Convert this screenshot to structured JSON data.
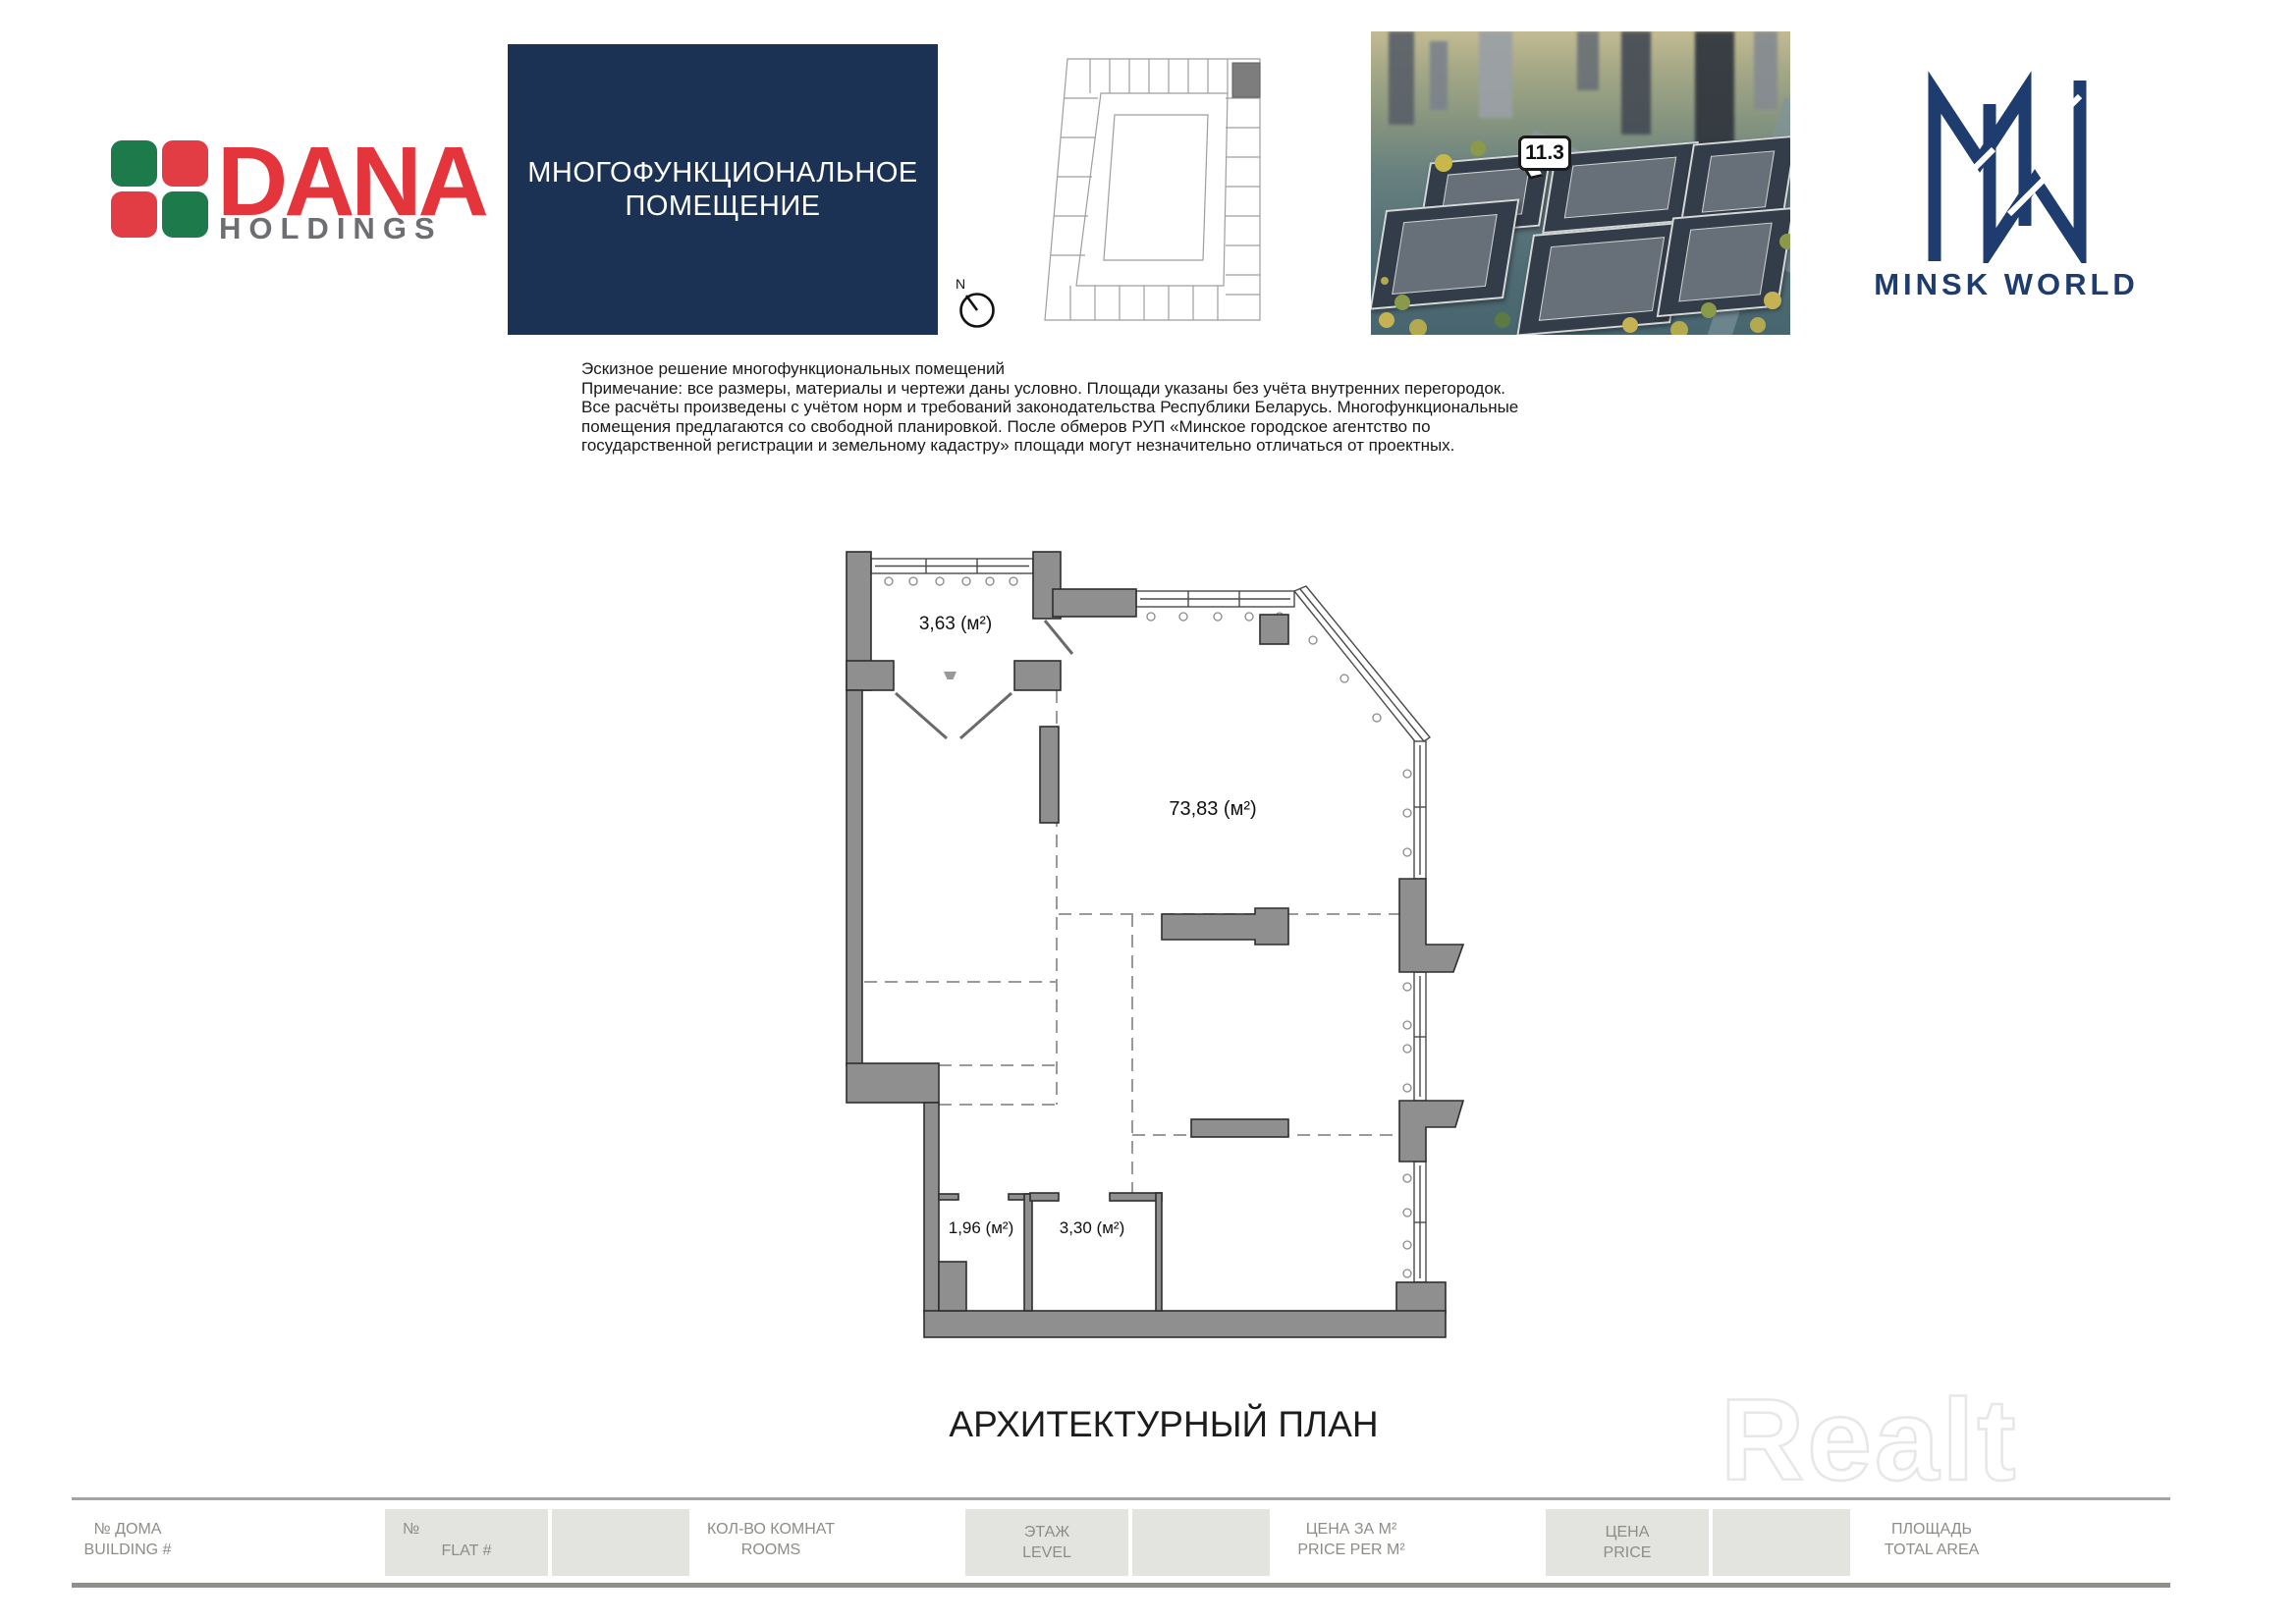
{
  "brand": {
    "dana": {
      "name": "DANA",
      "subtitle": "HOLDINGS"
    },
    "minsk_world": {
      "name": "MINSK WORLD"
    }
  },
  "title_box": {
    "line1": "МНОГОФУНКЦИОНАЛЬНОЕ",
    "line2": "ПОМЕЩЕНИЕ"
  },
  "site": {
    "compass": "N",
    "building_callout": "11.3"
  },
  "notes": {
    "line1": "Эскизное решение многофункциональных помещений",
    "line2": "Примечание: все размеры, материалы и чертежи даны условно. Площади указаны без учёта внутренних перегородок.",
    "line3": "Все расчёты произведены с учётом норм и требований законодательства Республики Беларусь. Многофункциональные",
    "line4": "помещения предлагаются со свободной планировкой. После обмеров РУП «Минское городское агентство по",
    "line5": "государственной регистрации и земельному кадастру» площади могут незначительно отличаться от проектных."
  },
  "plan": {
    "title": "АРХИТЕКТУРНЫЙ ПЛАН",
    "areas": {
      "balcony": "3,63 (м²)",
      "main": "73,83 (м²)",
      "small1": "1,96 (м²)",
      "small2": "3,30 (м²)"
    }
  },
  "watermark": "Realt",
  "footer": {
    "building": {
      "ru": "№ ДОМА",
      "en": "BUILDING #"
    },
    "flat": {
      "corner": "№",
      "en": "FLAT #"
    },
    "rooms": {
      "ru": "КОЛ-ВО КОМНАТ",
      "en": "ROOMS"
    },
    "level": {
      "ru": "ЭТАЖ",
      "en": "LEVEL"
    },
    "price_per_m": {
      "ru": "ЦЕНА ЗА М²",
      "en": "PRICE PER M²"
    },
    "price": {
      "ru": "ЦЕНА",
      "en": "PRICE"
    },
    "area": {
      "ru": "ПЛОЩАДЬ",
      "en": "TOTAL AREA"
    }
  },
  "colors": {
    "navy": "#1b3255",
    "logo_navy": "#1e3c6e",
    "dana_red": "#e5353c",
    "dana_green": "#1d7a4a",
    "wall_gray": "#8f8f8f",
    "footer_gray": "#e3e3e0",
    "footer_text": "#8d8d88"
  }
}
